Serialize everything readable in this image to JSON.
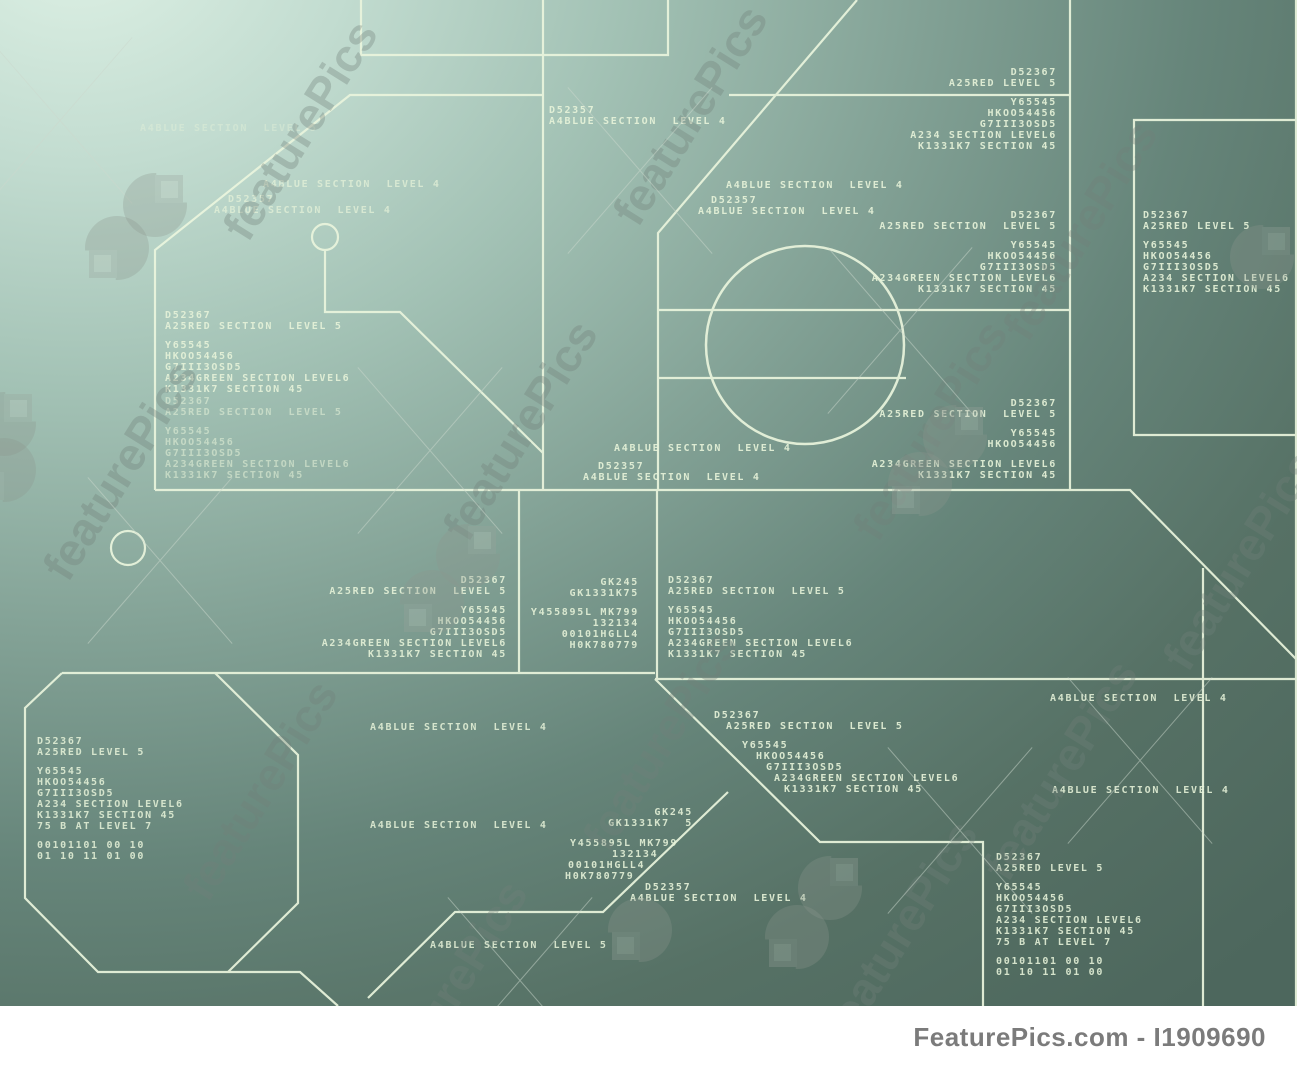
{
  "meta": {
    "watermark_text": "featurePics",
    "footer_text": "FeaturePics.com - I1909690"
  },
  "colors": {
    "line": "#eaf5dd",
    "label_text": "#e8f4da",
    "bg_light": "#def1e5",
    "bg_dark": "#4d675d",
    "watermark_grey": "#72807a",
    "footer_text": "#7b7b7b",
    "footer_bg": "#ffffff"
  },
  "blocks": [
    {
      "x": 140,
      "y": 124,
      "align": "left",
      "dim": 0.4,
      "lines": [
        {
          "t": "A4BLUE SECTION  LEVEL 5",
          "dx": 0
        }
      ]
    },
    {
      "x": 263,
      "y": 180,
      "align": "left",
      "dim": 0.7,
      "lines": [
        {
          "t": "A4BLUE SECTION  LEVEL 4",
          "dx": 0
        }
      ]
    },
    {
      "x": 228,
      "y": 195,
      "align": "left",
      "dim": 0.7,
      "lines": [
        {
          "t": "D52357",
          "dx": 0
        },
        {
          "t": "A4BLUE SECTION  LEVEL 4",
          "dx": -14
        }
      ]
    },
    {
      "x": 549,
      "y": 106,
      "align": "left",
      "dim": 0.9,
      "lines": [
        {
          "t": "D52357",
          "dx": 0
        },
        {
          "t": "A4BLUE SECTION  LEVEL 4",
          "dx": 0
        }
      ]
    },
    {
      "x": 726,
      "y": 181,
      "align": "left",
      "dim": 0.9,
      "lines": [
        {
          "t": "A4BLUE SECTION  LEVEL 4",
          "dx": 0
        }
      ]
    },
    {
      "x": 711,
      "y": 196,
      "align": "left",
      "dim": 0.9,
      "lines": [
        {
          "t": "D52357",
          "dx": 0
        },
        {
          "t": "A4BLUE SECTION  LEVEL 4",
          "dx": -13
        }
      ]
    },
    {
      "x": 1060,
      "y": 68,
      "align": "right",
      "dim": 0.9,
      "lines": [
        {
          "t": "D52367",
          "dx": 0
        },
        {
          "t": "A25RED LEVEL 5",
          "dx": 0
        },
        {
          "t": "",
          "dx": 0
        },
        {
          "t": "Y65545",
          "dx": 0
        },
        {
          "t": "HKOO54456",
          "dx": 0
        },
        {
          "t": "G7III3OSD5",
          "dx": 0
        },
        {
          "t": "A234 SECTION LEVEL6",
          "dx": 0
        },
        {
          "t": "K1331K7 SECTION 45",
          "dx": 0
        }
      ]
    },
    {
      "x": 1143,
      "y": 211,
      "align": "left",
      "dim": 0.9,
      "lines": [
        {
          "t": "D52367",
          "dx": 0
        },
        {
          "t": "A25RED LEVEL 5",
          "dx": 0
        },
        {
          "t": "",
          "dx": 0
        },
        {
          "t": "Y65545",
          "dx": 0
        },
        {
          "t": "HKOO54456",
          "dx": 0
        },
        {
          "t": "G7III3OSD5",
          "dx": 0
        },
        {
          "t": "A234 SECTION LEVEL6",
          "dx": 0
        },
        {
          "t": "K1331K7 SECTION 45",
          "dx": 0
        }
      ]
    },
    {
      "x": 1060,
      "y": 211,
      "align": "right",
      "dim": 0.9,
      "lines": [
        {
          "t": "D52367",
          "dx": 0
        },
        {
          "t": "A25RED SECTION  LEVEL 5",
          "dx": 0
        },
        {
          "t": "",
          "dx": 0
        },
        {
          "t": "Y65545",
          "dx": 0
        },
        {
          "t": "HKOO54456",
          "dx": 0
        },
        {
          "t": "G7III3OSD5",
          "dx": 0
        },
        {
          "t": "A234GREEN SECTION LEVEL6",
          "dx": 0
        },
        {
          "t": "K1331K7 SECTION 45",
          "dx": 0
        }
      ]
    },
    {
      "x": 165,
      "y": 311,
      "align": "left",
      "dim": 0.88,
      "lines": [
        {
          "t": "D52367",
          "dx": 0
        },
        {
          "t": "A25RED SECTION  LEVEL 5",
          "dx": 0
        },
        {
          "t": "",
          "dx": 0
        },
        {
          "t": "Y65545",
          "dx": 0
        },
        {
          "t": "HKOO54456",
          "dx": 0
        },
        {
          "t": "G7III3OSD5",
          "dx": 0
        },
        {
          "t": "A234GREEN SECTION LEVEL6",
          "dx": 0
        },
        {
          "t": "K1331K7 SECTION 45",
          "dx": 0
        }
      ]
    },
    {
      "x": 165,
      "y": 397,
      "align": "left",
      "dim": 0.55,
      "lines": [
        {
          "t": "D52367",
          "dx": 0
        },
        {
          "t": "A25RED SECTION  LEVEL 5",
          "dx": 0
        },
        {
          "t": "",
          "dx": 0
        },
        {
          "t": "Y65545",
          "dx": 0
        },
        {
          "t": "HKOO54456",
          "dx": 0
        },
        {
          "t": "G7III3OSD5",
          "dx": 0
        },
        {
          "t": "A234GREEN SECTION LEVEL6",
          "dx": 0
        },
        {
          "t": "K1331K7 SECTION 45",
          "dx": 0
        }
      ]
    },
    {
      "x": 1060,
      "y": 399,
      "align": "right",
      "dim": 0.9,
      "lines": [
        {
          "t": "D52367",
          "dx": 0
        },
        {
          "t": "A25RED SECTION  LEVEL 5",
          "dx": 0
        },
        {
          "t": "",
          "dx": 0
        },
        {
          "t": "Y65545",
          "dx": 0
        },
        {
          "t": "HKOO54456",
          "dx": 0
        },
        {
          "t": "",
          "dx": 0
        },
        {
          "t": "A234GREEN SECTION LEVEL6",
          "dx": 0
        },
        {
          "t": "K1331K7 SECTION 45",
          "dx": 0
        }
      ]
    },
    {
      "x": 614,
      "y": 444,
      "align": "left",
      "dim": 0.9,
      "lines": [
        {
          "t": "A4BLUE SECTION  LEVEL 4",
          "dx": 0
        }
      ]
    },
    {
      "x": 598,
      "y": 462,
      "align": "left",
      "dim": 0.9,
      "lines": [
        {
          "t": "D52357",
          "dx": 0
        },
        {
          "t": "A4BLUE SECTION  LEVEL 4",
          "dx": -15
        }
      ]
    },
    {
      "x": 510,
      "y": 576,
      "align": "right",
      "dim": 0.88,
      "lines": [
        {
          "t": "D52367",
          "dx": 0
        },
        {
          "t": "A25RED SECTION  LEVEL 5",
          "dx": 0
        },
        {
          "t": "",
          "dx": 0
        },
        {
          "t": "Y65545",
          "dx": 0
        },
        {
          "t": "HKOO54456",
          "dx": 0
        },
        {
          "t": "G7III3OSD5",
          "dx": 0
        },
        {
          "t": "A234GREEN SECTION LEVEL6",
          "dx": 0
        },
        {
          "t": "K1331K7 SECTION 45",
          "dx": 0
        }
      ]
    },
    {
      "x": 642,
      "y": 578,
      "align": "right",
      "dim": 0.88,
      "lines": [
        {
          "t": "GK245",
          "dx": 0
        },
        {
          "t": "GK1331K75",
          "dx": 0
        },
        {
          "t": "",
          "dx": 0
        },
        {
          "t": "Y455895L MK799",
          "dx": 0
        },
        {
          "t": "132134",
          "dx": 0
        },
        {
          "t": "00101HGLL4",
          "dx": 0
        },
        {
          "t": "H0K780779",
          "dx": 0
        }
      ]
    },
    {
      "x": 668,
      "y": 576,
      "align": "left",
      "dim": 0.88,
      "lines": [
        {
          "t": "D52367",
          "dx": 0
        },
        {
          "t": "A25RED SECTION  LEVEL 5",
          "dx": 0
        },
        {
          "t": "",
          "dx": 0
        },
        {
          "t": "Y65545",
          "dx": 0
        },
        {
          "t": "HKOO54456",
          "dx": 0
        },
        {
          "t": "G7III3OSD5",
          "dx": 0
        },
        {
          "t": "A234GREEN SECTION LEVEL6",
          "dx": 0
        },
        {
          "t": "K1331K7 SECTION 45",
          "dx": 0
        }
      ]
    },
    {
      "x": 370,
      "y": 723,
      "align": "left",
      "dim": 0.85,
      "lines": [
        {
          "t": "A4BLUE SECTION  LEVEL 4",
          "dx": 0
        }
      ]
    },
    {
      "x": 37,
      "y": 737,
      "align": "left",
      "dim": 0.85,
      "lines": [
        {
          "t": "D52367",
          "dx": 0
        },
        {
          "t": "A25RED LEVEL 5",
          "dx": 0
        },
        {
          "t": "",
          "dx": 0
        },
        {
          "t": "Y65545",
          "dx": 0
        },
        {
          "t": "HKOO54456",
          "dx": 0
        },
        {
          "t": "G7III3OSD5",
          "dx": 0
        },
        {
          "t": "A234 SECTION LEVEL6",
          "dx": 0
        },
        {
          "t": "K1331K7 SECTION 45",
          "dx": 0
        },
        {
          "t": "75 B AT LEVEL 7",
          "dx": 0
        },
        {
          "t": "",
          "dx": 0
        },
        {
          "t": "00101101 00 10",
          "dx": 0
        },
        {
          "t": "01 10 11 01 00",
          "dx": 0
        }
      ]
    },
    {
      "x": 714,
      "y": 711,
      "align": "left",
      "dim": 0.9,
      "lines": [
        {
          "t": "D52367",
          "dx": 0
        },
        {
          "t": "A25RED SECTION  LEVEL 5",
          "dx": 12
        },
        {
          "t": "",
          "dx": 0
        },
        {
          "t": "Y65545",
          "dx": 28
        },
        {
          "t": "HKOO54456",
          "dx": 42
        },
        {
          "t": "G7III3OSD5",
          "dx": 52
        },
        {
          "t": "A234GREEN SECTION LEVEL6",
          "dx": 60
        },
        {
          "t": "K1331K7 SECTION 45",
          "dx": 70
        }
      ]
    },
    {
      "x": 370,
      "y": 821,
      "align": "left",
      "dim": 0.85,
      "lines": [
        {
          "t": "A4BLUE SECTION  LEVEL 4",
          "dx": 0
        }
      ]
    },
    {
      "x": 696,
      "y": 808,
      "align": "right",
      "dim": 0.88,
      "lines": [
        {
          "t": "GK245",
          "dx": 0
        },
        {
          "t": "GK1331K7  5",
          "dx": 0
        }
      ]
    },
    {
      "x": 570,
      "y": 839,
      "align": "left",
      "dim": 0.88,
      "lines": [
        {
          "t": "Y455895L MK799",
          "dx": 0
        },
        {
          "t": "132134",
          "dx": 42
        },
        {
          "t": "00101HGLL4",
          "dx": -2
        },
        {
          "t": "H0K780779",
          "dx": -5
        }
      ]
    },
    {
      "x": 645,
      "y": 883,
      "align": "left",
      "dim": 0.9,
      "lines": [
        {
          "t": "D52357",
          "dx": 0
        },
        {
          "t": "A4BLUE SECTION  LEVEL 4",
          "dx": -15
        }
      ]
    },
    {
      "x": 430,
      "y": 941,
      "align": "left",
      "dim": 0.85,
      "lines": [
        {
          "t": "A4BLUE SECTION  LEVEL 5",
          "dx": 0
        }
      ]
    },
    {
      "x": 1050,
      "y": 694,
      "align": "left",
      "dim": 0.88,
      "lines": [
        {
          "t": "A4BLUE SECTION  LEVEL 4",
          "dx": 0
        }
      ]
    },
    {
      "x": 1052,
      "y": 786,
      "align": "left",
      "dim": 0.88,
      "lines": [
        {
          "t": "A4BLUE SECTION  LEVEL 4",
          "dx": 0
        }
      ]
    },
    {
      "x": 996,
      "y": 853,
      "align": "left",
      "dim": 0.88,
      "lines": [
        {
          "t": "D52367",
          "dx": 0
        },
        {
          "t": "A25RED LEVEL 5",
          "dx": 0
        },
        {
          "t": "",
          "dx": 0
        },
        {
          "t": "Y65545",
          "dx": 0
        },
        {
          "t": "HKOO54456",
          "dx": 0
        },
        {
          "t": "G7III3OSD5",
          "dx": 0
        },
        {
          "t": "A234 SECTION LEVEL6",
          "dx": 0
        },
        {
          "t": "K1331K7 SECTION 45",
          "dx": 0
        },
        {
          "t": "75 B AT LEVEL 7",
          "dx": 0
        },
        {
          "t": "",
          "dx": 0
        },
        {
          "t": "00101101 00 10",
          "dx": 0
        },
        {
          "t": "01 10 11 01 00",
          "dx": 0
        }
      ]
    }
  ]
}
